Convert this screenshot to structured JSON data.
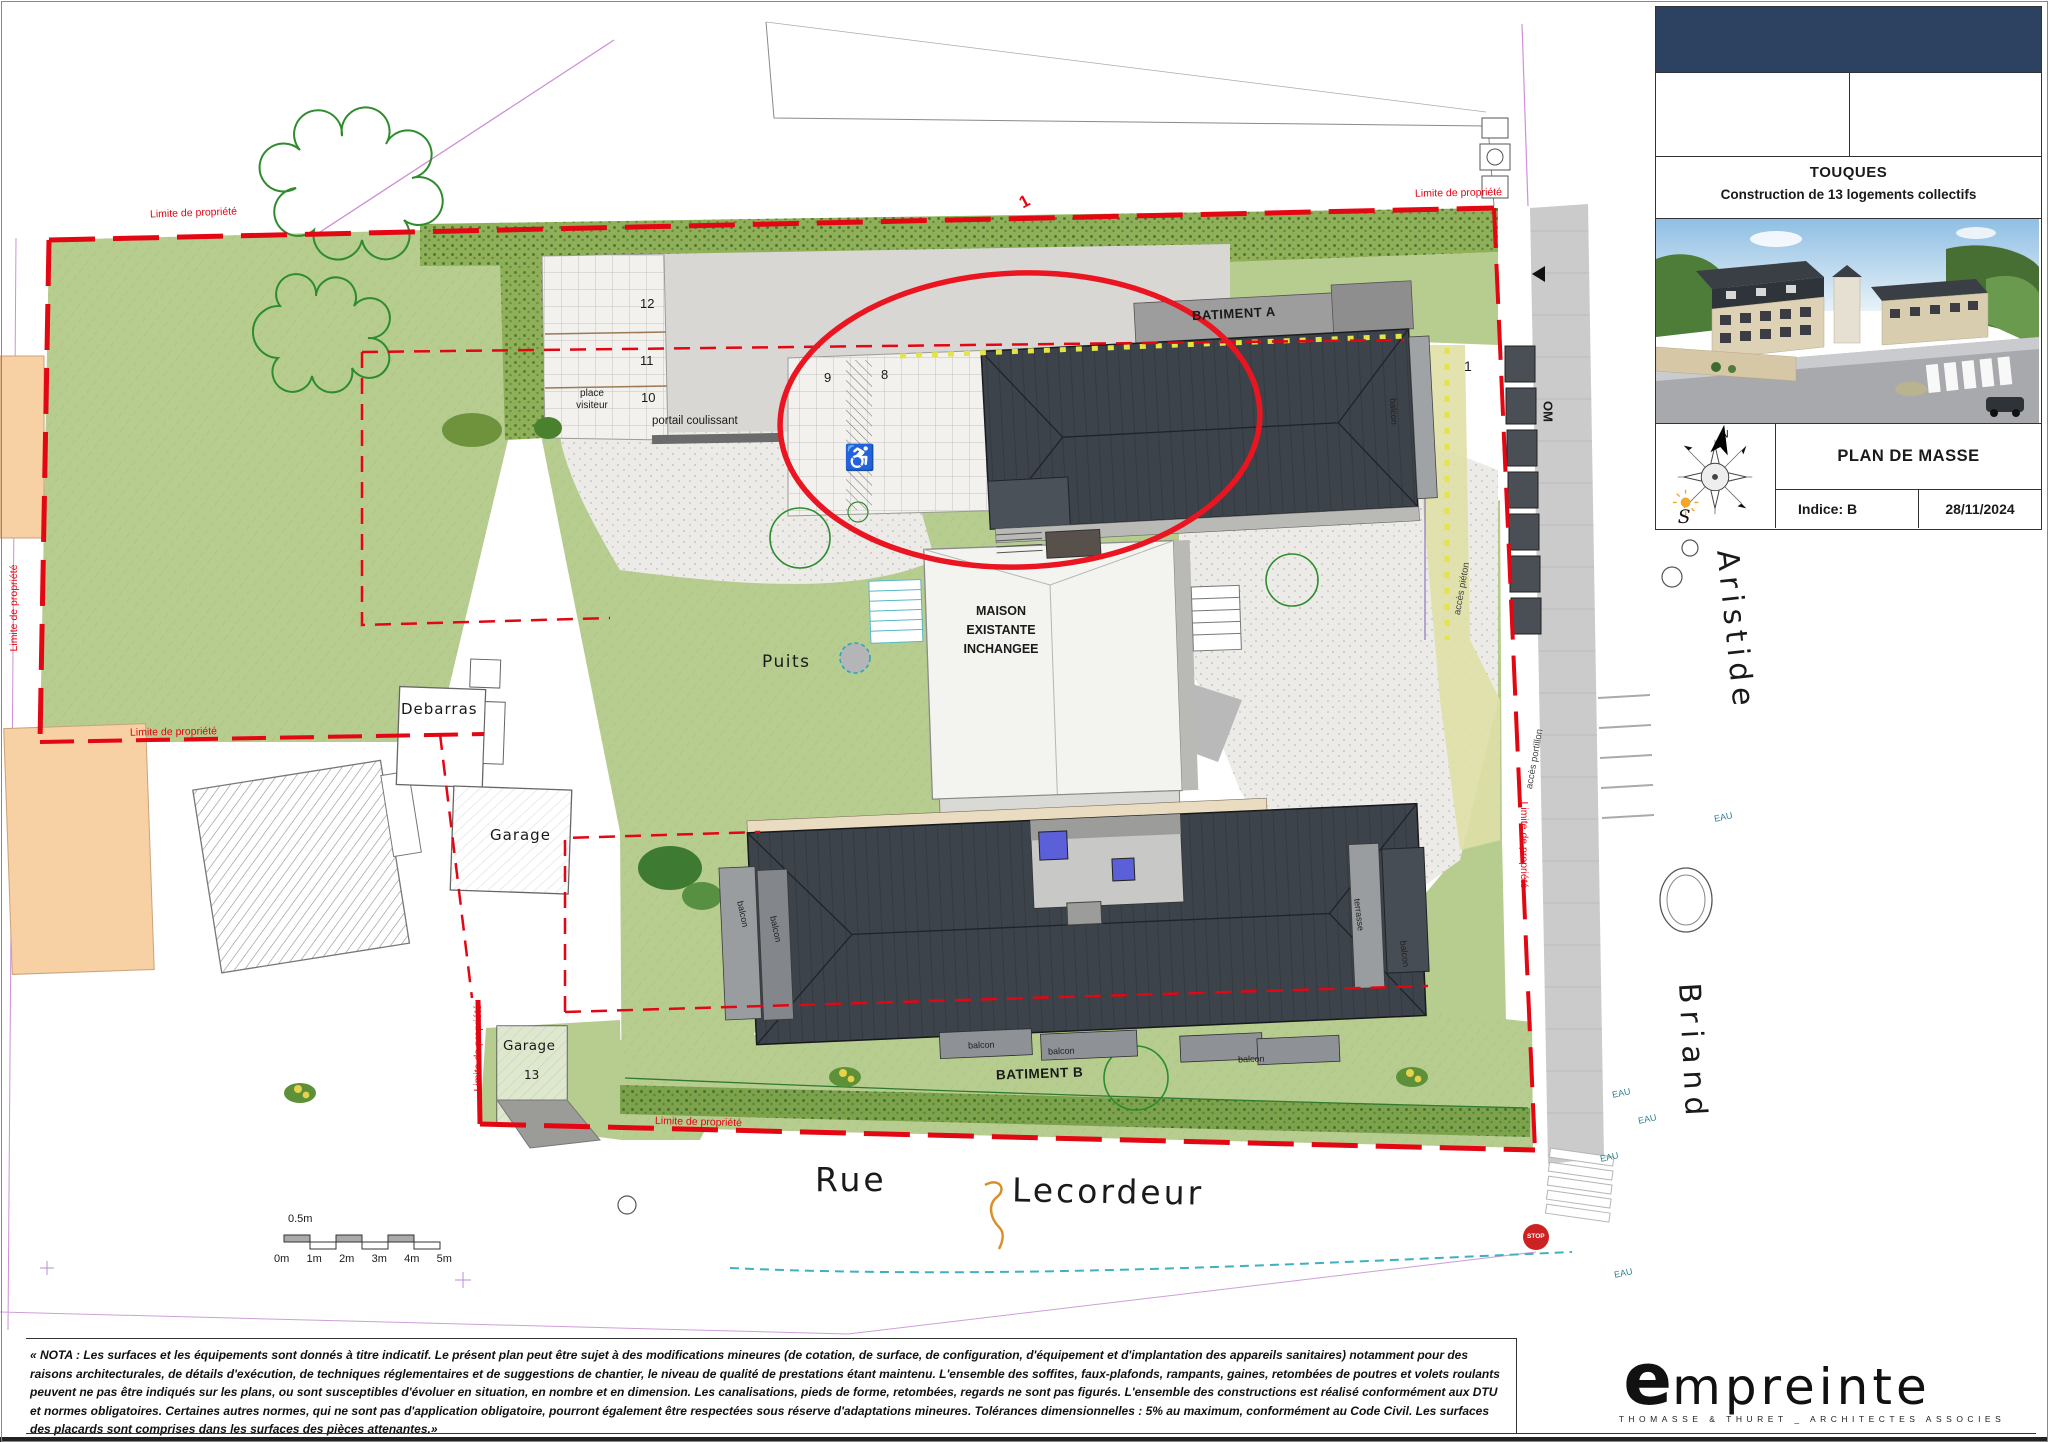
{
  "title_block": {
    "city": "TOUQUES",
    "project": "Construction de 13 logements collectifs",
    "drawing_title": "PLAN DE MASSE",
    "indice": "Indice:  B",
    "date": "28/11/2024",
    "compass_n": "N",
    "compass_s": "S"
  },
  "plan": {
    "boundary_label": "Limite de propriété",
    "batiment_a": "BATIMENT A",
    "batiment_b": "BATIMENT B",
    "maison_lines": [
      "MAISON",
      "EXISTANTE",
      "INCHANGEE"
    ],
    "puits": "Puits",
    "debarras": "Debarras",
    "garage": "Garage",
    "garage13_num": "13",
    "portail": "portail coulissant",
    "place_visiteur_1": "place",
    "place_visiteur_2": "visiteur",
    "parking": {
      "p12": "12",
      "p11": "11",
      "p10": "10",
      "p9": "9",
      "p8": "8",
      "p1": "1"
    },
    "red_mark": "1",
    "om": "OM",
    "acces_pieton": "accès piéton",
    "acces_portillon": "accès portillon",
    "balcon": "balcon",
    "terrasse": "terrasse",
    "eau": "EAU",
    "stop": "STOP",
    "handicap_icon": "♿"
  },
  "streets": {
    "rue": "Rue",
    "lecordeur": "Lecordeur",
    "aristide": "Aristide",
    "briand": "Briand"
  },
  "scale_bar": {
    "half_label": "0.5m",
    "ticks": [
      "0m",
      "1m",
      "2m",
      "3m",
      "4m",
      "5m"
    ]
  },
  "nota": {
    "text": "« NOTA : Les surfaces et les équipements sont donnés à titre indicatif. Le présent plan peut être sujet à des modifications mineures (de cotation, de surface, de configuration, d'équipement et d'implantation des appareils sanitaires) notamment pour des raisons architecturales, de détails d'exécution, de techniques réglementaires et de suggestions de chantier, le niveau de qualité de prestations étant maintenu. L'ensemble des soffites, faux-plafonds, rampants, gaines, retombées de poutres et volets roulants peuvent ne pas être indiqués sur les plans, ou sont susceptibles d'évoluer en situation, en nombre et en dimension. Les canalisations, pieds de forme, retombées, regards ne sont pas figurés. L'ensemble des constructions est réalisé conformément aux DTU et normes obligatoires. Certaines autres normes, qui ne sont pas d'application obligatoire, pourront également être respectées sous réserve d'adaptations mineures. Tolérances dimensionnelles : 5% au maximum, conformément au Code Civil. Les surfaces des placards sont comprises dans les surfaces des pièces attenantes.»"
  },
  "logo": {
    "name_first": "e",
    "name_rest": "mpreinte",
    "tagline": "THOMASSE & THURET _ ARCHITECTES ASSOCIES"
  },
  "colors": {
    "boundary_red": "#e30613",
    "annotation_red": "#ea1520",
    "title_bar_navy": "#2d4160",
    "lawn_green": "#b7cd8f",
    "roof_slate": "#3d434a"
  }
}
